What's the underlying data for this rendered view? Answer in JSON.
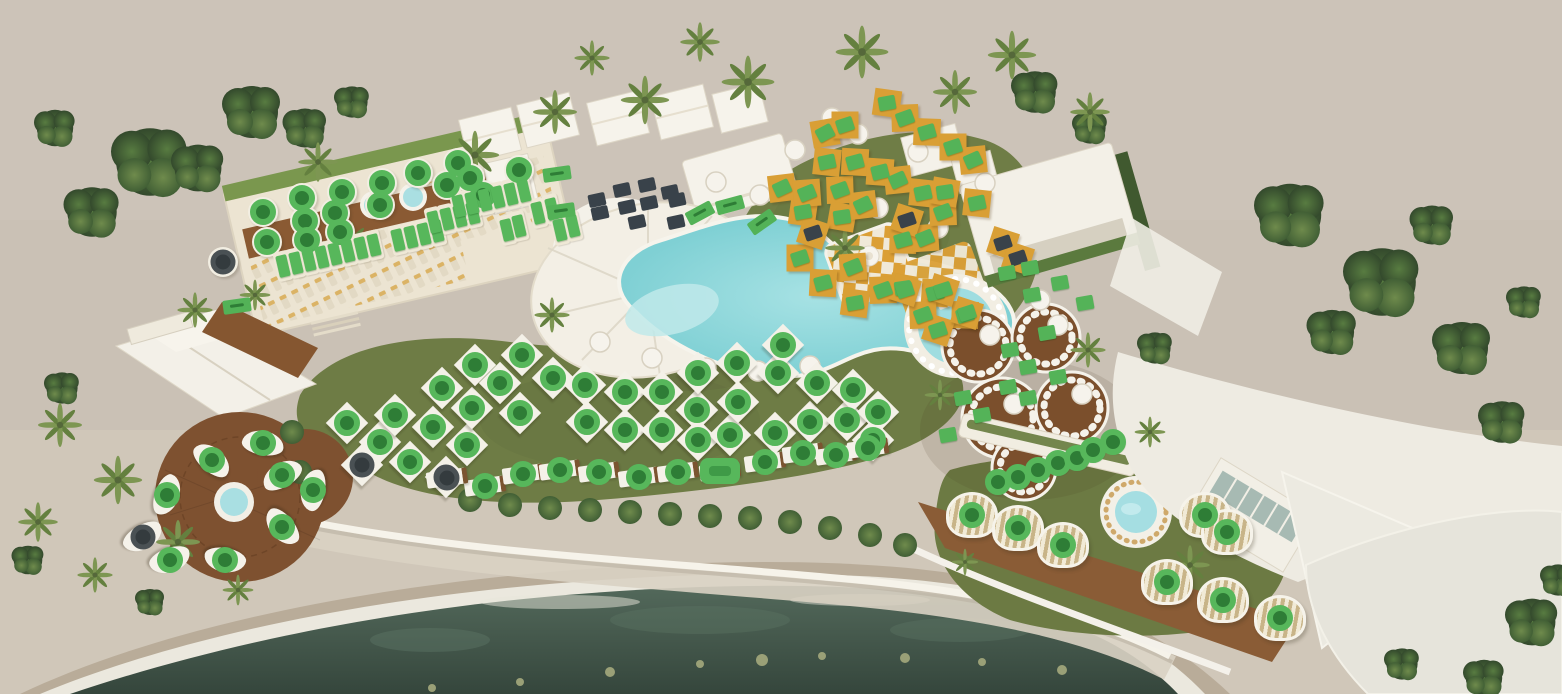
{
  "meta": {
    "view": "beach-club-aerial-plan",
    "legend": {
      "available_color": "#57b75b",
      "available_dark_color": "#2e7d36",
      "booked_color": "#39424a"
    }
  },
  "marker_zones": [
    {
      "name": "rooftop-terrace-table",
      "marker": "circle",
      "status": "available",
      "furniture": "table",
      "items": [
        [
          263,
          212
        ],
        [
          267,
          242
        ],
        [
          302,
          198
        ],
        [
          305,
          221
        ],
        [
          307,
          240
        ],
        [
          335,
          213
        ],
        [
          340,
          232
        ],
        [
          342,
          192
        ],
        [
          380,
          205
        ],
        [
          382,
          183
        ],
        [
          418,
          173
        ],
        [
          447,
          185
        ],
        [
          458,
          163
        ],
        [
          470,
          178
        ],
        [
          483,
          195
        ],
        [
          519,
          170
        ]
      ]
    },
    {
      "name": "rooftop-terrace-sunbed",
      "marker": "vrect",
      "status": "available",
      "furniture": "sunbed",
      "rot": -13,
      "furn_rot": -13,
      "items": [
        [
          283,
          266
        ],
        [
          296,
          263
        ],
        [
          309,
          260
        ],
        [
          322,
          257
        ],
        [
          335,
          254
        ],
        [
          348,
          251
        ],
        [
          361,
          248
        ],
        [
          374,
          245
        ],
        [
          398,
          240
        ],
        [
          411,
          237
        ],
        [
          424,
          234
        ],
        [
          437,
          231
        ],
        [
          434,
          222
        ],
        [
          447,
          219
        ],
        [
          460,
          216
        ],
        [
          473,
          213
        ],
        [
          459,
          206
        ],
        [
          472,
          203
        ],
        [
          485,
          200
        ],
        [
          498,
          197
        ],
        [
          511,
          194
        ],
        [
          524,
          191
        ],
        [
          507,
          230
        ],
        [
          519,
          226
        ],
        [
          538,
          213
        ],
        [
          552,
          209
        ],
        [
          560,
          230
        ],
        [
          573,
          226
        ]
      ]
    },
    {
      "name": "terrace-info-flag",
      "marker": "flag",
      "status": "available",
      "rot": -8,
      "items": [
        [
          557,
          174
        ],
        [
          561,
          211
        ],
        [
          237,
          306
        ]
      ]
    },
    {
      "name": "restaurant-booth-booked",
      "marker": "dsquare",
      "status": "booked",
      "rot": -12,
      "items": [
        [
          597,
          200
        ],
        [
          600,
          213
        ],
        [
          622,
          190
        ],
        [
          627,
          207
        ],
        [
          637,
          222
        ],
        [
          647,
          185
        ],
        [
          649,
          203
        ],
        [
          670,
          192
        ],
        [
          677,
          200
        ],
        [
          676,
          222
        ]
      ]
    },
    {
      "name": "gold-daybed",
      "marker": "square",
      "status": "available",
      "furniture": "dia",
      "furn_rot": 18,
      "rot": -18,
      "items": [
        [
          782,
          188,
          -25
        ],
        [
          800,
          258,
          -18
        ],
        [
          803,
          212,
          -10
        ],
        [
          807,
          193,
          -22
        ],
        [
          823,
          283,
          -15
        ],
        [
          825,
          133,
          -28
        ],
        [
          827,
          162,
          -12
        ],
        [
          840,
          190,
          -20
        ],
        [
          842,
          217,
          -8
        ],
        [
          845,
          125,
          -18
        ],
        [
          853,
          267,
          -22
        ],
        [
          855,
          162,
          -15
        ],
        [
          855,
          303,
          -10
        ],
        [
          863,
          205,
          -25
        ],
        [
          880,
          172,
          -14
        ],
        [
          883,
          290,
          -20
        ],
        [
          887,
          103,
          -10
        ],
        [
          898,
          180,
          -24
        ],
        [
          903,
          240,
          -16
        ],
        [
          903,
          288,
          -8
        ],
        [
          905,
          118,
          -20
        ],
        [
          923,
          193,
          -12
        ],
        [
          925,
          238,
          -22
        ],
        [
          927,
          132,
          -16
        ],
        [
          935,
          293,
          -14
        ],
        [
          943,
          212,
          -20
        ],
        [
          945,
          192,
          -8
        ],
        [
          953,
          147,
          -18
        ],
        [
          973,
          160,
          -24
        ],
        [
          977,
          203,
          -12
        ],
        [
          965,
          315,
          -16
        ],
        [
          923,
          315,
          -20
        ]
      ]
    },
    {
      "name": "gold-daybed-booked",
      "marker": "dsquare",
      "status": "booked",
      "furniture": "dia",
      "furn_rot": 18,
      "rot": -18,
      "items": [
        [
          813,
          233
        ],
        [
          907,
          220
        ],
        [
          1003,
          243
        ],
        [
          1018,
          258
        ]
      ]
    },
    {
      "name": "round-pool-daybed",
      "marker": "square",
      "status": "available",
      "furniture": "dia",
      "furn_rot": 18,
      "rot": -18,
      "items": [
        [
          905,
          290
        ],
        [
          943,
          290
        ],
        [
          938,
          330
        ],
        [
          967,
          313
        ]
      ]
    },
    {
      "name": "vip-booth",
      "marker": "square",
      "status": "available",
      "rot": -10,
      "items": [
        [
          1010,
          350
        ],
        [
          1028,
          367
        ],
        [
          1047,
          333
        ],
        [
          1058,
          377
        ],
        [
          1008,
          387
        ],
        [
          963,
          398
        ],
        [
          1028,
          398
        ],
        [
          982,
          415
        ],
        [
          948,
          435
        ],
        [
          1085,
          303
        ],
        [
          1060,
          283
        ],
        [
          1030,
          268
        ],
        [
          1032,
          295
        ],
        [
          1007,
          273
        ]
      ]
    },
    {
      "name": "bar-seat",
      "marker": "circle",
      "status": "available",
      "furniture": "chair",
      "items": [
        [
          998,
          482
        ],
        [
          1018,
          477
        ],
        [
          1038,
          470
        ],
        [
          1058,
          463
        ],
        [
          1077,
          458
        ],
        [
          1093,
          450
        ],
        [
          1113,
          442
        ]
      ]
    },
    {
      "name": "garden-cabana",
      "marker": "circle",
      "status": "available",
      "furniture": "cab",
      "items": [
        [
          972,
          515
        ],
        [
          1018,
          528
        ],
        [
          1063,
          545
        ],
        [
          1167,
          582
        ],
        [
          1223,
          600
        ],
        [
          1280,
          618
        ],
        [
          1205,
          515
        ],
        [
          1227,
          532
        ]
      ]
    },
    {
      "name": "garden-daybed",
      "marker": "circle",
      "status": "available",
      "furniture": "fly",
      "furn_rot": 45,
      "items": [
        [
          347,
          423
        ],
        [
          380,
          442
        ],
        [
          395,
          415
        ],
        [
          410,
          462
        ],
        [
          433,
          427
        ],
        [
          442,
          388
        ],
        [
          467,
          445
        ],
        [
          472,
          408
        ],
        [
          475,
          365
        ],
        [
          500,
          383
        ],
        [
          520,
          413
        ],
        [
          522,
          355
        ],
        [
          553,
          378
        ],
        [
          585,
          385
        ],
        [
          587,
          422
        ],
        [
          625,
          392
        ],
        [
          625,
          430
        ],
        [
          662,
          392
        ],
        [
          662,
          430
        ],
        [
          697,
          410
        ],
        [
          698,
          373
        ],
        [
          698,
          440
        ],
        [
          730,
          435
        ],
        [
          737,
          363
        ],
        [
          738,
          402
        ],
        [
          775,
          433
        ],
        [
          778,
          373
        ],
        [
          783,
          345
        ],
        [
          810,
          422
        ],
        [
          817,
          383
        ],
        [
          847,
          420
        ],
        [
          853,
          390
        ],
        [
          878,
          412
        ],
        [
          873,
          440
        ]
      ]
    },
    {
      "name": "garden-daybed-booked",
      "marker": "dcircle",
      "status": "booked",
      "furniture": "fly",
      "furn_rot": 45,
      "items": [
        [
          362,
          465
        ],
        [
          446,
          477
        ]
      ]
    },
    {
      "name": "front-row-lounger",
      "marker": "circle",
      "status": "available",
      "furniture": "lng",
      "furn_rot": -8,
      "items": [
        [
          485,
          486
        ],
        [
          523,
          474
        ],
        [
          560,
          470
        ],
        [
          599,
          472
        ],
        [
          639,
          477
        ],
        [
          678,
          472
        ],
        [
          765,
          462
        ],
        [
          803,
          453
        ],
        [
          836,
          455
        ],
        [
          868,
          448
        ]
      ]
    },
    {
      "name": "front-row-premium",
      "marker": "pill",
      "status": "available",
      "furniture": "lng",
      "furn_rot": -8,
      "items": [
        [
          720,
          471
        ]
      ]
    },
    {
      "name": "front-row-booked",
      "marker": "dcircle",
      "status": "booked",
      "furniture": "lng",
      "furn_rot": -8,
      "items": [
        [
          447,
          478
        ]
      ]
    },
    {
      "name": "rooftop-table-booked",
      "marker": "dcircle",
      "status": "booked",
      "furniture": "table",
      "items": [
        [
          223,
          262
        ]
      ]
    },
    {
      "name": "firepit-sofa-booked",
      "marker": "dcircle",
      "status": "booked",
      "furniture": "sofa",
      "furn_rot": 150,
      "items": [
        [
          143,
          537
        ]
      ]
    },
    {
      "name": "firepit-deck-sofa",
      "marker": "circle",
      "status": "available",
      "furniture": "sofa",
      "items": [
        [
          212,
          460,
          40
        ],
        [
          263,
          443,
          10
        ],
        [
          282,
          475,
          -30
        ],
        [
          313,
          490,
          -80
        ],
        [
          282,
          527,
          -130
        ],
        [
          225,
          560,
          -170
        ],
        [
          170,
          560,
          160
        ],
        [
          167,
          495,
          110
        ]
      ]
    },
    {
      "name": "poolside-daybed",
      "marker": "flag",
      "status": "available",
      "items": [
        [
          700,
          213,
          -28
        ],
        [
          730,
          205,
          -15
        ],
        [
          762,
          222,
          -35
        ]
      ]
    }
  ]
}
